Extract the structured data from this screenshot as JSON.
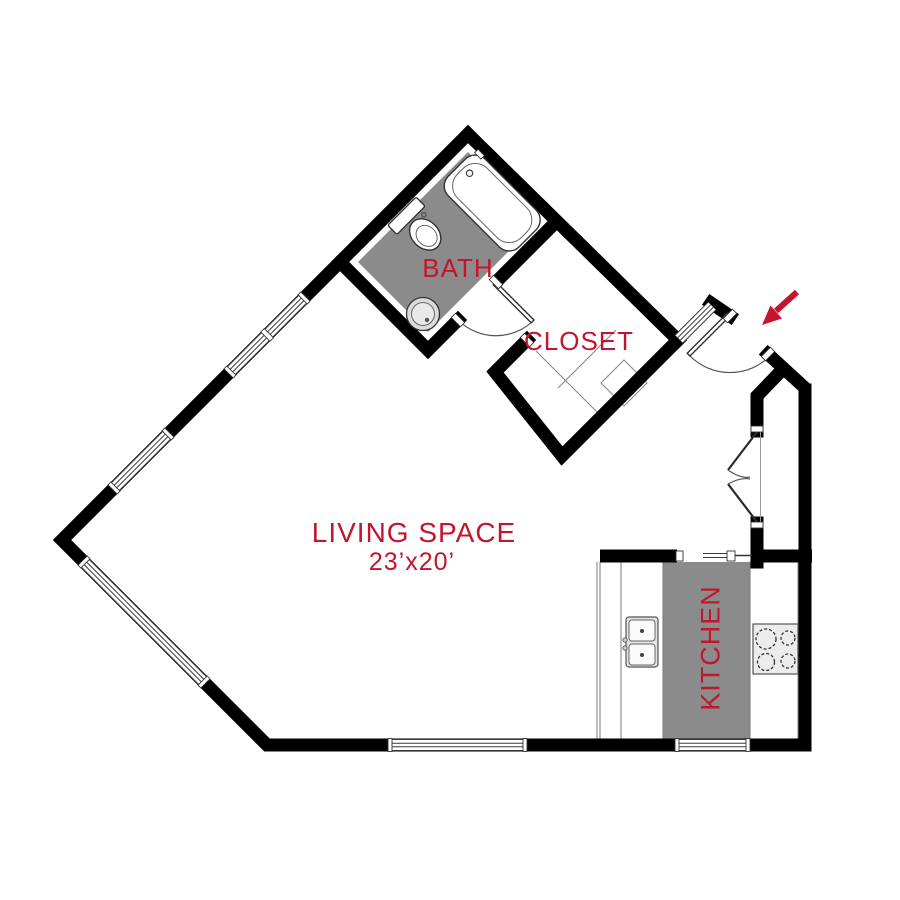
{
  "floorplan": {
    "rooms": {
      "bath": {
        "label": "BATH"
      },
      "closet": {
        "label": "CLOSET"
      },
      "living_space": {
        "label": "LIVING SPACE",
        "dimensions": "23’x20’"
      },
      "kitchen": {
        "label": "KITCHEN"
      }
    },
    "colors": {
      "wall": "#000000",
      "label_red": "#c4152f",
      "floor_gray": "#8b8b8b"
    },
    "entry": {
      "icon": "entry-arrow"
    }
  }
}
